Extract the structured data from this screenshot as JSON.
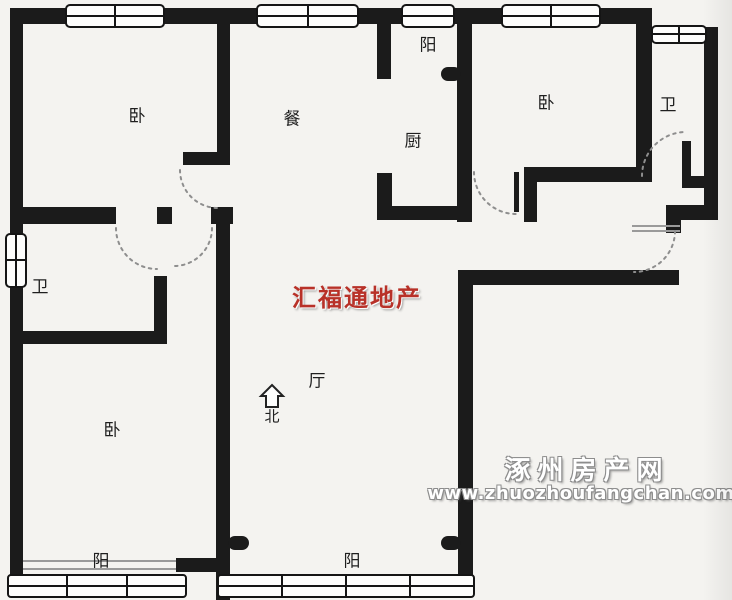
{
  "floorplan": {
    "rooms": {
      "bed_tl": "卧",
      "dining": "餐",
      "balcony_top": "阳",
      "kitchen": "厨",
      "bed_tr": "卧",
      "bath_tr": "卫",
      "bath_l": "卫",
      "living": "厅",
      "bed_bl": "卧",
      "balcony_bl": "阳",
      "balcony_bc": "阳"
    },
    "compass": {
      "label": "北",
      "icon": "north-arrow-icon"
    },
    "watermarks": {
      "agency_name": "汇福通地产",
      "agency_color": "#b83128",
      "site_name": "涿州房产网",
      "site_url": "www.zhuozhoufangchan.com"
    },
    "colors": {
      "background": "#f4f3f0",
      "wall": "#1b1b1b",
      "door_arc": "#8e8e8e",
      "window_border": "#151515"
    }
  }
}
